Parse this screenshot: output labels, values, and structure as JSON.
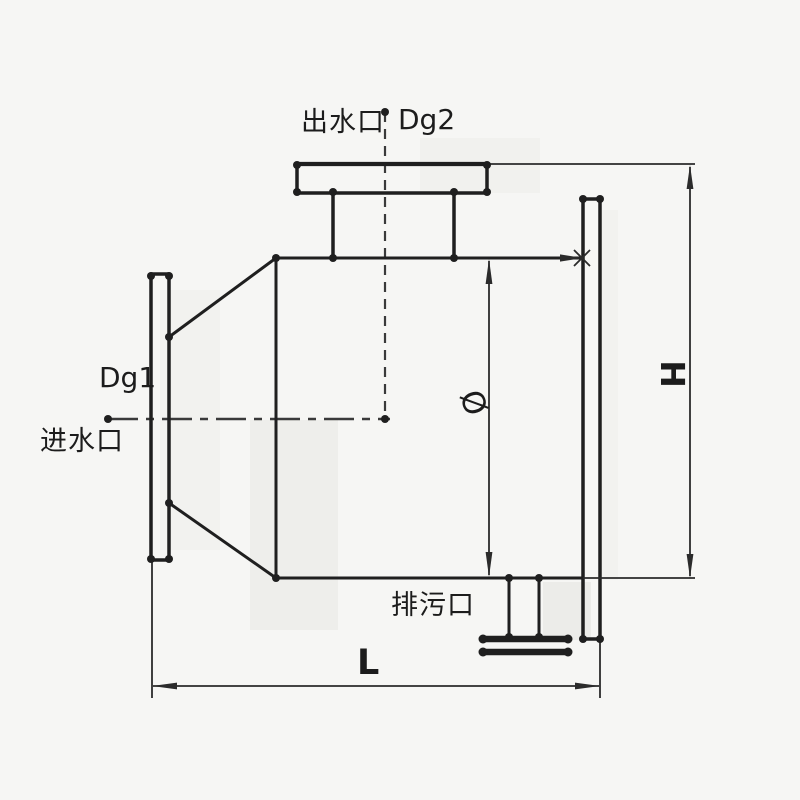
{
  "diagram": {
    "type": "technical-drawing",
    "subject": "pipeline vessel with inlet, outlet and drain flanges",
    "labels": {
      "outlet_port": "出水口",
      "outlet_nominal_diameter": "Dg2",
      "inlet_nominal_diameter": "Dg1",
      "inlet_port": "进水口",
      "drain_port": "排污口",
      "length_dimension": "L",
      "height_dimension": "H",
      "diameter_symbol": "Ø"
    },
    "colors": {
      "background": "#f6f6f4",
      "line": "#1f1f1f",
      "dimension_line": "#2b2b2b",
      "centerline": "#3a3a3a",
      "text": "#1c1c1c"
    }
  }
}
